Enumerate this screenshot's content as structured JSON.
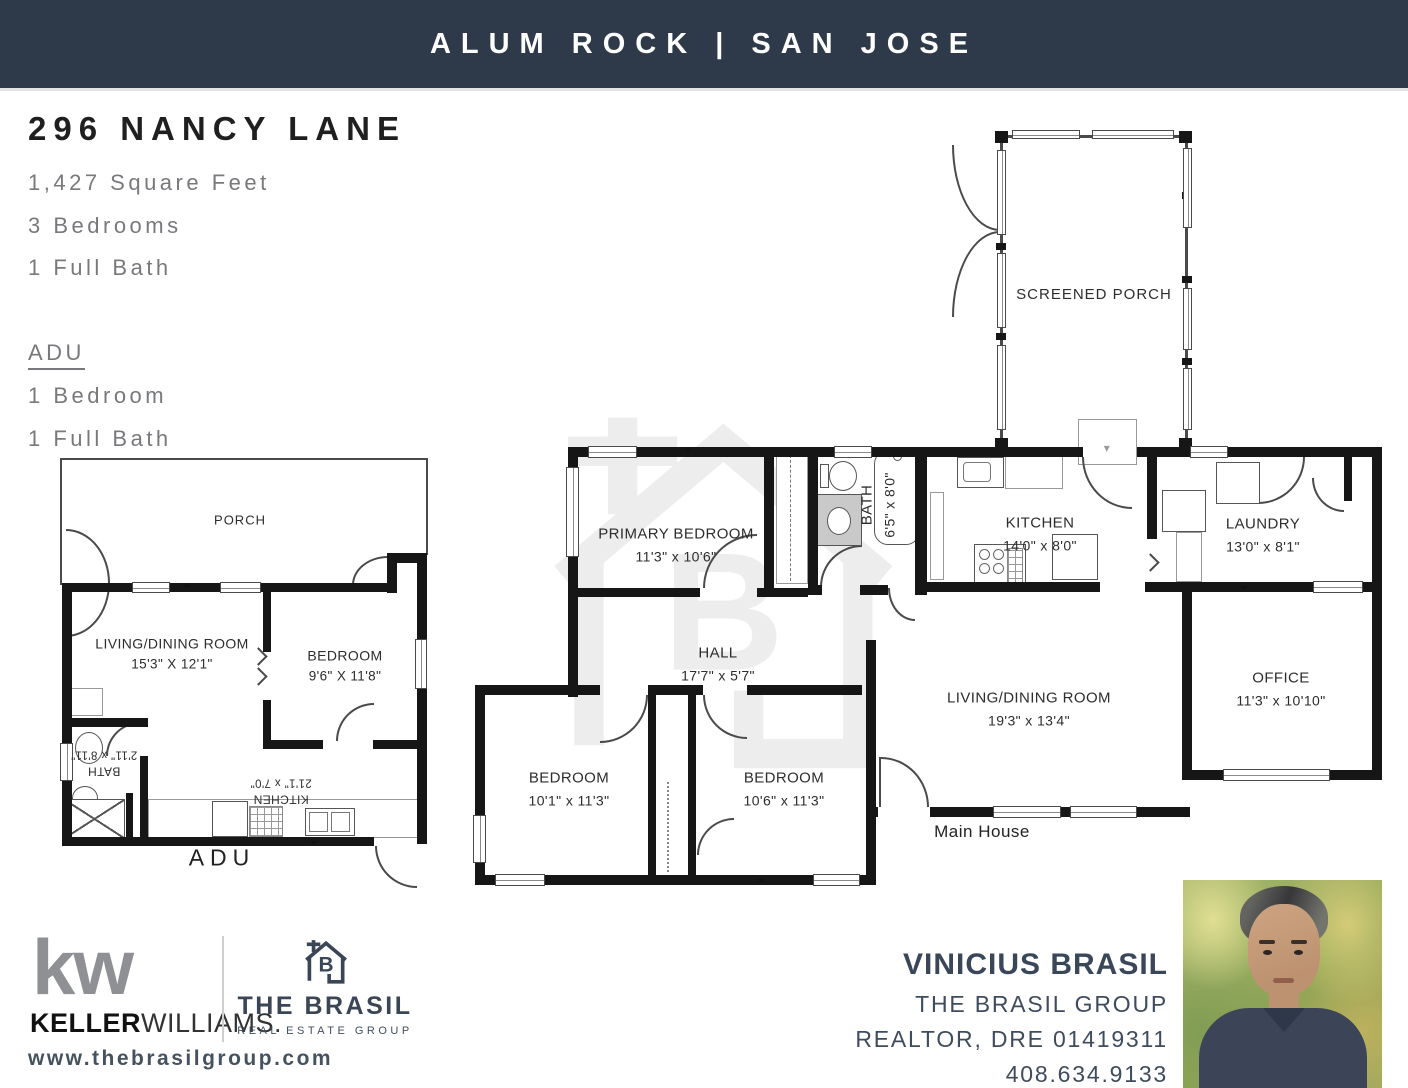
{
  "header": {
    "title": "ALUM ROCK | SAN JOSE"
  },
  "property": {
    "address": "296 NANCY LANE",
    "sqft": "1,427 Square Feet",
    "beds": "3 Bedrooms",
    "bath": "1 Full Bath",
    "adu_heading": "ADU",
    "adu_beds": "1 Bedroom",
    "adu_bath": "1 Full Bath"
  },
  "adu_plan": {
    "porch": "PORCH",
    "caption": "ADU",
    "living": {
      "name": "LIVING/DINING ROOM",
      "dims": "15'3\" X 12'1\""
    },
    "bedroom": {
      "name": "BEDROOM",
      "dims": "9'6\" X 11'8\""
    },
    "bath": {
      "name": "BATH",
      "dims": "2'11\" x 8'11\""
    },
    "kitchen": {
      "name": "KITCHEN",
      "dims": "21'1\" x 7'0\""
    }
  },
  "main_plan": {
    "caption": "Main House",
    "screened_porch": "SCREENED PORCH",
    "primary_bedroom": {
      "name": "PRIMARY BEDROOM",
      "dims": "11'3\" x 10'6\""
    },
    "bath": {
      "name": "BATH",
      "dims": "6'5\" x 8'0\""
    },
    "kitchen": {
      "name": "KITCHEN",
      "dims": "14'0\" x 8'0\""
    },
    "laundry": {
      "name": "LAUNDRY",
      "dims": "13'0\" x 8'1\""
    },
    "hall": {
      "name": "HALL",
      "dims": "17'7\" x 5'7\""
    },
    "living": {
      "name": "LIVING/DINING ROOM",
      "dims": "19'3\" x 13'4\""
    },
    "office": {
      "name": "OFFICE",
      "dims": "11'3\" x 10'10\""
    },
    "bedroom_left": {
      "name": "BEDROOM",
      "dims": "10'1\" x 11'3\""
    },
    "bedroom_right": {
      "name": "BEDROOM",
      "dims": "10'6\" x 11'3\""
    }
  },
  "footer": {
    "kw_mark": "kw",
    "kw_bold": "KELLER",
    "kw_light": "WILLIAMS.",
    "brasil_letter": "B",
    "brasil_title": "THE BRASIL",
    "brasil_subtitle": "REAL ESTATE GROUP",
    "website": "www.thebrasilgroup.com",
    "agent_name": "VINICIUS BRASIL",
    "agent_team": "THE BRASIL GROUP",
    "agent_license": "REALTOR, DRE 01419311",
    "agent_phone": "408.634.9133"
  },
  "colors": {
    "header_bg": "#2e3a49",
    "navy": "#3a4656",
    "gray_text": "#77797c",
    "wall": "#161616",
    "watermark": "#ededed"
  }
}
